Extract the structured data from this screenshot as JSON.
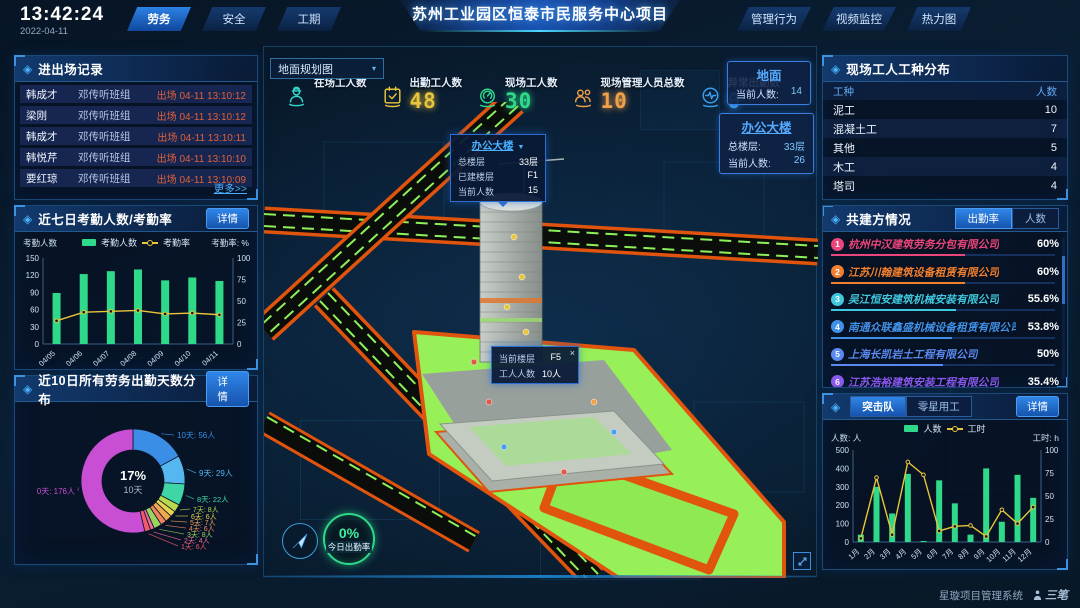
{
  "icons": {
    "panel_diamond": "◈",
    "dropdown_caret": "▾",
    "popup_caret": "▼",
    "close": "×"
  },
  "header": {
    "time": "13:42:24",
    "date": "2022-04-11",
    "nav_left": [
      {
        "label": "劳务",
        "active": true
      },
      {
        "label": "安全",
        "active": false
      },
      {
        "label": "工期",
        "active": false
      }
    ],
    "title": "苏州工业园区恒泰市民服务中心项目",
    "nav_right": [
      {
        "label": "管理行为",
        "active": false
      },
      {
        "label": "视频监控",
        "active": false
      },
      {
        "label": "热力图",
        "active": false
      }
    ]
  },
  "entry_exit": {
    "title": "进出场记录",
    "rows": [
      {
        "name": "韩成才",
        "team": "邓传听班组",
        "event": "出场 04-11 13:10:12"
      },
      {
        "name": "梁刚",
        "team": "邓传听班组",
        "event": "出场 04-11 13:10:12"
      },
      {
        "name": "韩成才",
        "team": "邓传听班组",
        "event": "出场 04-11 13:10:11"
      },
      {
        "name": "韩悦芹",
        "team": "邓传听班组",
        "event": "出场 04-11 13:10:10"
      },
      {
        "name": "要红琼",
        "team": "邓传听班组",
        "event": "出场 04-11 13:10:09"
      }
    ],
    "more": "更多>>"
  },
  "attendance": {
    "title": "近七日考勤人数/考勤率",
    "detail": "详情",
    "axis_left": "考勤人数",
    "axis_right": "考勤率: %",
    "chart_data": {
      "type": "bar+line",
      "categories": [
        "04/05",
        "04/06",
        "04/07",
        "04/08",
        "04/09",
        "04/10",
        "04/11"
      ],
      "series": [
        {
          "name": "考勤人数",
          "type": "bar",
          "axis": "left",
          "color": "#2fd98a",
          "values": [
            89,
            122,
            127,
            130,
            111,
            116,
            110
          ]
        },
        {
          "name": "考勤率",
          "type": "line",
          "axis": "right",
          "color": "#e8c53a",
          "values": [
            27,
            37,
            38,
            39,
            35,
            36,
            34
          ]
        }
      ],
      "ylim_left": [
        0,
        150
      ],
      "yticks_left": [
        0,
        30,
        60,
        90,
        120,
        150
      ],
      "ylim_right": [
        0,
        100
      ],
      "yticks_right": [
        0,
        25,
        50,
        75,
        100
      ]
    }
  },
  "day_distribution": {
    "title": "近10日所有劳务出勤天数分布",
    "detail": "详情",
    "chart_data": {
      "type": "donut",
      "center_percent": "17%",
      "center_label": "10天",
      "slices": [
        {
          "label": "10天: 56人",
          "value": 56,
          "color": "#3a8ee6"
        },
        {
          "label": "9天: 29人",
          "value": 29,
          "color": "#55b6f0"
        },
        {
          "label": "8天: 22人",
          "value": 22,
          "color": "#3ed6a5"
        },
        {
          "label": "7天: 8人",
          "value": 8,
          "color": "#b8d84e"
        },
        {
          "label": "6天: 6人",
          "value": 6,
          "color": "#e8d44e"
        },
        {
          "label": "5天: 7人",
          "value": 7,
          "color": "#f0a84e"
        },
        {
          "label": "4天: 6人",
          "value": 6,
          "color": "#f0845e"
        },
        {
          "label": "3天: 8人",
          "value": 8,
          "color": "#9ad45e"
        },
        {
          "label": "2天: 4人",
          "value": 4,
          "color": "#f06a9a"
        },
        {
          "label": "1天: 6人",
          "value": 6,
          "color": "#f05a6a"
        },
        {
          "label": "0天: 176人",
          "value": 176,
          "color": "#c84fd4"
        }
      ]
    }
  },
  "scene": {
    "view_select": "地面规划图",
    "stats": [
      {
        "label": "在场工人数",
        "value": "",
        "color": "#35d4c8",
        "icon": "worker"
      },
      {
        "label": "出勤工人数",
        "value": "48",
        "color": "#e8c53a",
        "icon": "calendar-check"
      },
      {
        "label": "现场工人数",
        "value": "30",
        "color": "#2fd98a",
        "icon": "gauge"
      },
      {
        "label": "现场管理人员总数",
        "value": "10",
        "color": "#f0a04a",
        "icon": "people"
      },
      {
        "label": "异常出勤数",
        "value": "0",
        "color": "#3aa0f0",
        "icon": "pulse"
      }
    ],
    "building_popup": {
      "title": "办公大楼",
      "rows": [
        [
          "总楼层",
          "33层"
        ],
        [
          "已建楼层",
          "F1"
        ],
        [
          "当前人数",
          "15"
        ]
      ]
    },
    "floor_popup": {
      "rows": [
        [
          "当前楼层",
          "F5"
        ],
        [
          "工人人数",
          "10人"
        ]
      ]
    },
    "ground_card": {
      "title": "地面",
      "rows": [
        [
          "当前人数:",
          "14"
        ]
      ]
    },
    "building_card": {
      "title": "办公大楼",
      "rows": [
        [
          "总楼层:",
          "33层"
        ],
        [
          "当前人数:",
          "26"
        ]
      ]
    },
    "today_rate": {
      "value": "0%",
      "label": "今日出勤率"
    }
  },
  "worker_types": {
    "title": "现场工人工种分布",
    "headers": [
      "工种",
      "人数"
    ],
    "rows": [
      [
        "泥工",
        "10"
      ],
      [
        "混凝土工",
        "7"
      ],
      [
        "其他",
        "5"
      ],
      [
        "木工",
        "4"
      ],
      [
        "塔司",
        "4"
      ]
    ]
  },
  "partners": {
    "title": "共建方情况",
    "tabs": [
      {
        "label": "出勤率",
        "active": true
      },
      {
        "label": "人数",
        "active": false
      }
    ],
    "rows": [
      {
        "rank": "1",
        "name": "杭州中汉建筑劳务分包有限公司",
        "value": "60%",
        "pct": 60,
        "color": "#e8467c"
      },
      {
        "rank": "2",
        "name": "江苏川翰建筑设备租赁有限公司",
        "value": "60%",
        "pct": 60,
        "color": "#f08030"
      },
      {
        "rank": "3",
        "name": "吴江恒安建筑机械安装有限公司",
        "value": "55.6%",
        "pct": 55.6,
        "color": "#40c8e0"
      },
      {
        "rank": "4",
        "name": "南通众联鑫盛机械设备租赁有限公司",
        "value": "53.8%",
        "pct": 53.8,
        "color": "#4090e8"
      },
      {
        "rank": "5",
        "name": "上海长凯岩土工程有限公司",
        "value": "50%",
        "pct": 50,
        "color": "#5a8af0"
      },
      {
        "rank": "6",
        "name": "江苏浩裕建筑安装工程有限公司",
        "value": "35.4%",
        "pct": 35.4,
        "color": "#8a5af0"
      }
    ]
  },
  "squad": {
    "tabs": [
      {
        "label": "突击队",
        "active": true
      },
      {
        "label": "零星用工",
        "active": false
      }
    ],
    "detail": "详情",
    "axis_left": "人数: 人",
    "axis_right": "工时: h",
    "chart_data": {
      "type": "bar+line",
      "categories": [
        "1月",
        "2月",
        "3月",
        "4月",
        "5月",
        "6月",
        "7月",
        "8月",
        "9月",
        "10月",
        "11月",
        "12月"
      ],
      "series": [
        {
          "name": "人数",
          "type": "bar",
          "axis": "left",
          "color": "#2fd98a",
          "values": [
            40,
            300,
            155,
            370,
            5,
            335,
            210,
            40,
            400,
            110,
            365,
            240
          ]
        },
        {
          "name": "工时",
          "type": "line",
          "axis": "right",
          "color": "#e8c53a",
          "values": [
            4,
            70,
            8,
            87,
            73,
            12,
            17,
            18,
            6,
            35,
            20,
            38
          ]
        }
      ],
      "ylim_left": [
        0,
        500
      ],
      "yticks_left": [
        0,
        100,
        200,
        300,
        400,
        500
      ],
      "ylim_right": [
        0,
        100
      ],
      "yticks_right": [
        0,
        25,
        50,
        75,
        100
      ]
    }
  },
  "footer": {
    "system": "星璇项目管理系统",
    "brand": "三笔"
  }
}
